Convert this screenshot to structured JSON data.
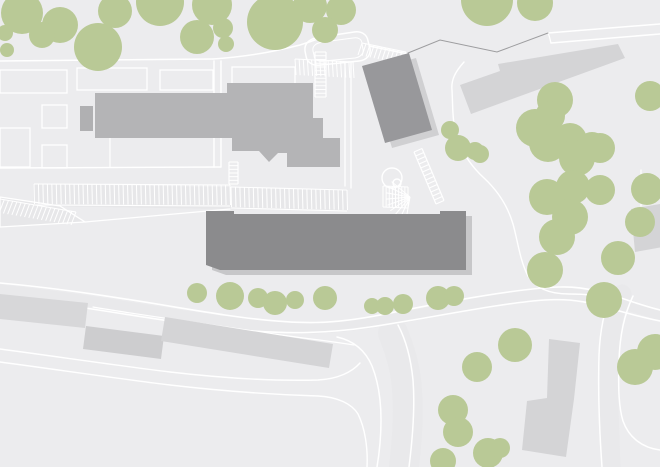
{
  "canvas": {
    "width": 660,
    "height": 467
  },
  "palette": {
    "background": "#ececee",
    "roadSurface": "#e9e9eb",
    "parkingSurface": "#e7e7e9",
    "line": "#ffffff",
    "boundary": "#9d9d9f",
    "tree": "#b9c996",
    "buildingMain": "#b4b4b6",
    "buildingAnnex": "#b0b0b2",
    "buildingDark": "#98989b",
    "buildingLong": "#8b8b8d",
    "shadowLong": "#c7c7c9",
    "shadowDark": "#d0d0d2",
    "buildingLightA": "#d7d7d9",
    "buildingLightB": "#cdcdcf",
    "buildingLightC": "#d4d4d6"
  },
  "map": {
    "layers": [
      {
        "name": "background-layer",
        "type": "fills",
        "color": "background",
        "items": [
          {
            "d": "M0,0 L660,0 L660,467 L0,467 Z",
            "name": "ground"
          }
        ]
      },
      {
        "name": "road-surface-layer",
        "type": "paths",
        "color": "roadSurface",
        "items": [
          {
            "d": "M0,290 C90,299 170,315 228,322 C300,332 335,329 395,319 C455,308 520,293 555,293 C585,293 620,302 660,315",
            "w": 11,
            "name": "main-road-surface"
          },
          {
            "d": "M393,333 C400,350 406,370 407,390 C409,415 407,440 404,467",
            "w": 30,
            "name": "south-branch-surface"
          },
          {
            "d": "M622,294 C613,312 609,335 609,365 C608,400 610,430 611,467",
            "w": 19,
            "name": "east-road-surface"
          }
        ]
      },
      {
        "name": "parking-surface-layer",
        "type": "fills",
        "color": "parkingSurface",
        "items": [
          {
            "d": "M33,184 L347,189 L347,211 L33,206 Z",
            "name": "parking-lot-surface"
          },
          {
            "d": "M0,197 L60,206 L85,222 L0,227 Z",
            "name": "parking-wedge-surface"
          }
        ]
      },
      {
        "name": "road-line-layer",
        "type": "paths",
        "color": "line",
        "items": [
          {
            "d": "M0,61 L213,59",
            "w": 1.5,
            "name": "north-street"
          },
          {
            "d": "M213,59 C255,56 280,50 300,45 C310,42 315,40 320,38",
            "w": 1.5,
            "name": "north-street-curve"
          },
          {
            "d": "M321,37 C310,38 304,43 305,51 L306,56 C307,63 313,66 321,65 L359,61 C367,60 371,55 370,48 L368,41 C367,34 361,31 354,32 Z",
            "w": 1.5,
            "name": "turnaround-loop-outer"
          },
          {
            "d": "M323,42 C316,43 312,46 313,51 L314,55 C314,60 318,62 324,61 L355,58 C361,57 364,53 363,49 L362,44 C362,39 358,37 353,38 Z",
            "w": 1,
            "name": "turnaround-loop-inner"
          },
          {
            "d": "M369,46 L408,54",
            "w": 1.5,
            "name": "loop-spur"
          },
          {
            "d": "M214,61 L214,167",
            "w": 1.4,
            "name": "access-lane-west-edge"
          },
          {
            "d": "M221,61 L221,167",
            "w": 1.4,
            "name": "access-lane-east-edge"
          },
          {
            "d": "M0,168 L221,167",
            "w": 1.4,
            "name": "parking-approach"
          },
          {
            "d": "M110,94 L110,167",
            "w": 1.2,
            "name": "plot-divider"
          },
          {
            "d": "M345,63 L345,186",
            "w": 1.3,
            "name": "service-lane-west"
          },
          {
            "d": "M351,63 L351,188",
            "w": 1.3,
            "name": "service-lane-east"
          },
          {
            "d": "M548,33 L660,24",
            "w": 1.5,
            "name": "northeast-road-upper"
          },
          {
            "d": "M551,43 L660,34",
            "w": 1.5,
            "name": "northeast-road-lower"
          },
          {
            "d": "M548,33 C550,37 550,40 551,43",
            "w": 1.3,
            "name": "northeast-road-cap"
          },
          {
            "d": "M464,62 C455,72 451,80 452,90 C453,108 452,124 458,140 C464,156 473,168 484,178 C498,191 508,207 513,224 C518,242 520,261 528,276 C536,289 551,294 569,294 C584,294 599,295 609,299",
            "w": 1.4,
            "name": "grove-footpath"
          },
          {
            "d": "M641,170 L641,206",
            "w": 1.2,
            "name": "east-building-path"
          },
          {
            "d": "M0,283 C90,291 170,307 225,315 C300,326 335,325 395,312 C450,301 520,288 560,287 C585,286 610,294 630,301 C645,306 652,308 660,310",
            "w": 1.6,
            "name": "main-road-north-edge"
          },
          {
            "d": "M0,296 C90,307 170,323 230,329 C290,335 330,333 370,327 C430,318 500,303 545,300 C575,298 595,304 612,309 C630,314 645,318 660,321",
            "w": 1.6,
            "name": "main-road-south-edge"
          },
          {
            "d": "M93,307 C140,315 200,323 260,332 C300,338 330,341 354,345",
            "w": 1.2,
            "name": "lower-terrace-line"
          },
          {
            "d": "M0,349 C60,357 120,366 170,372 C230,379 280,381 318,380 C338,379 352,372 360,363",
            "w": 1.4,
            "name": "sidewalk-upper"
          },
          {
            "d": "M0,362 C60,370 120,379 170,385 C230,392 285,395 318,396 C338,397 352,404 358,414 C365,428 368,448 367,467",
            "w": 1.4,
            "name": "sidewalk-lower"
          },
          {
            "d": "M337,337 C355,341 366,352 372,366 C378,381 381,400 381,420 C381,440 379,455 377,467",
            "w": 1.5,
            "name": "south-branch-west-edge"
          },
          {
            "d": "M398,325 C406,340 411,360 413,380 C415,405 413,435 409,467",
            "w": 1.5,
            "name": "south-branch-east-edge"
          },
          {
            "d": "M612,292 C604,310 600,330 599,355 C598,390 599,425 602,467",
            "w": 1.5,
            "name": "east-road-west-edge"
          },
          {
            "d": "M633,296 C624,315 620,335 619,360 C618,390 619,408 623,421 C629,438 643,448 660,450",
            "w": 1.5,
            "name": "east-road-east-edge"
          }
        ]
      },
      {
        "name": "plot-outline-layer",
        "type": "rects",
        "color": "line",
        "items": [
          [
            0,
            70,
            67,
            23
          ],
          [
            77,
            68,
            70,
            22
          ],
          [
            160,
            70,
            53,
            20
          ],
          [
            232,
            67,
            63,
            21
          ],
          [
            0,
            128,
            30,
            39
          ],
          [
            42,
            105,
            25,
            23
          ],
          [
            42,
            145,
            25,
            23
          ]
        ]
      },
      {
        "name": "parking-outline-layer",
        "type": "paths",
        "color": "line",
        "items": [
          {
            "d": "M0,197 L60,206 L85,222 L0,227 Z",
            "w": 1.3,
            "name": "parking-wedge-outline"
          },
          {
            "d": "M85,222 L230,209",
            "w": 1.3,
            "name": "parking-wedge-connector"
          }
        ]
      },
      {
        "name": "parking-stall-layer",
        "type": "ticks",
        "color": "line",
        "items": [
          {
            "b": [
              34,
              184,
              230,
              185
            ],
            "t": [
              0.5,
              20
            ],
            "n": 44,
            "bot": [
              34,
              205,
              230,
              206
            ],
            "name": "stall-row-west"
          },
          {
            "b": [
              231,
              187,
              347,
              190
            ],
            "t": [
              0.5,
              20
            ],
            "n": 26,
            "bot": [
              231,
              208,
              347,
              211
            ],
            "name": "stall-row-east"
          },
          {
            "b": [
              383,
              186,
              408,
              187
            ],
            "t": [
              0,
              21
            ],
            "n": 8,
            "bot": [
              383,
              207,
              408,
              208
            ],
            "name": "stall-row-detail"
          },
          {
            "b": [
              295,
              59,
              353,
              62
            ],
            "t": [
              1,
              16
            ],
            "n": 14,
            "name": "stall-row-loop-south"
          },
          {
            "b": [
              362,
              43,
              406,
              52
            ],
            "t": [
              -4,
              12
            ],
            "n": 11,
            "name": "stall-row-loop-east"
          },
          {
            "b": [
              0,
              199,
              76,
              212
            ],
            "t": [
              -5,
              13
            ],
            "n": 18,
            "name": "wedge-hatch"
          }
        ]
      },
      {
        "name": "stairs-layer",
        "type": "ladders",
        "color": "line",
        "items": [
          {
            "a": [
              315,
              52,
              315,
              97
            ],
            "o": [
              11,
              0
            ],
            "n": 12,
            "name": "stairs-north"
          },
          {
            "a": [
              414,
              152,
              436,
              204
            ],
            "o": [
              8,
              -3.5
            ],
            "n": 13,
            "name": "stairs-east-ramp"
          },
          {
            "a": [
              229,
              162,
              229,
              184
            ],
            "o": [
              9,
              0
            ],
            "n": 6,
            "name": "stairs-parking"
          }
        ]
      },
      {
        "name": "courtyard-detail-layer",
        "type": "fan",
        "color": "line",
        "items": [
          {
            "c": [
              410,
              197
            ],
            "r": 24,
            "angles": [
              100,
              115,
              130,
              145,
              160,
              175,
              190,
              205,
              220
            ],
            "name": "bike-rack-fan"
          }
        ]
      },
      {
        "name": "courtyard-ring-layer",
        "type": "rings",
        "color": "line",
        "items": [
          [
            392,
            178,
            10
          ],
          [
            397,
            183,
            4
          ]
        ]
      },
      {
        "name": "boundary-layer",
        "type": "paths",
        "color": "boundary",
        "items": [
          {
            "d": "M408,53 L440,40 L497,52 L548,33",
            "w": 1,
            "name": "property-boundary"
          }
        ]
      },
      {
        "name": "shadow-layer",
        "type": "polys",
        "items": [
          {
            "d": "M206,211 L234,211 L234,214 L440,214 L440,211 L466,211 L466,270 L220,270 L206,265 Z",
            "fill": "shadowLong",
            "t": "translate(6,5)",
            "name": "long-building-shadow"
          },
          {
            "d": "M362,66 L409,53 L432,130 L385,143 Z",
            "fill": "shadowDark",
            "t": "translate(7,5)",
            "name": "hall-shadow"
          }
        ]
      },
      {
        "name": "building-layer",
        "type": "polys",
        "items": [
          {
            "d": "M80,106 L93,106 L93,131 L80,131 Z",
            "fill": "buildingAnnex",
            "name": "building-annex"
          },
          {
            "d": "M95,93 L227,93 L227,83 L313,83 L313,118 L323,118 L323,138 L340,138 L340,167 L287,167 L287,153 L278,153 L269,162 L259,151 L232,151 L232,138 L95,138 Z",
            "fill": "buildingMain",
            "name": "building-main-complex"
          },
          {
            "d": "M362,66 L409,53 L432,130 L385,143 Z",
            "fill": "buildingDark",
            "name": "building-hall"
          },
          {
            "d": "M206,211 L234,211 L234,214 L440,214 L440,211 L466,211 L466,270 L220,270 L206,265 Z",
            "fill": "buildingLong",
            "name": "building-long-block"
          },
          {
            "d": "M0,294 L88,303 L85,328 L0,319 Z",
            "fill": "buildingLightA",
            "name": "building-row-west"
          },
          {
            "d": "M86,326 L164,336 L161,359 L83,349 Z",
            "fill": "buildingLightB",
            "name": "building-row-middle"
          },
          {
            "d": "M165,317 L333,344 L329,368 L161,341 Z",
            "fill": "buildingLightC",
            "name": "building-row-east"
          },
          {
            "d": "M549,339 L580,343 L574,399 L566,457 L522,450 L527,401 L547,398 Z",
            "fill": "buildingLightC",
            "name": "building-south-tower"
          },
          {
            "d": "M631,209 L660,204 L663,247 L635,252 Z",
            "fill": "buildingLightC",
            "name": "building-east-small"
          },
          {
            "d": "M460,85 L500,71 L498,64 L618,44 L625,58 L471,114 Z",
            "fill": "buildingLightC",
            "name": "building-northeast-slab"
          }
        ]
      },
      {
        "name": "tree-layer",
        "type": "circles",
        "color": "tree",
        "items": [
          [
            22,
            13,
            21
          ],
          [
            5,
            33,
            8
          ],
          [
            7,
            50,
            7
          ],
          [
            60,
            25,
            18
          ],
          [
            42,
            35,
            13
          ],
          [
            98,
            47,
            24
          ],
          [
            115,
            11,
            17
          ],
          [
            160,
            2,
            24
          ],
          [
            197,
            37,
            17
          ],
          [
            212,
            5,
            20
          ],
          [
            223,
            28,
            10
          ],
          [
            226,
            44,
            8
          ],
          [
            275,
            22,
            28
          ],
          [
            310,
            6,
            17
          ],
          [
            341,
            10,
            15
          ],
          [
            325,
            30,
            13
          ],
          [
            487,
            0,
            26
          ],
          [
            535,
            3,
            18
          ],
          [
            450,
            130,
            9
          ],
          [
            456,
            147,
            10
          ],
          [
            475,
            151,
            9
          ],
          [
            458,
            148,
            13
          ],
          [
            480,
            154,
            9
          ],
          [
            555,
            100,
            18
          ],
          [
            550,
            116,
            15
          ],
          [
            535,
            128,
            19
          ],
          [
            570,
            140,
            17
          ],
          [
            592,
            147,
            15
          ],
          [
            650,
            96,
            15
          ],
          [
            548,
            143,
            19
          ],
          [
            577,
            158,
            18
          ],
          [
            600,
            148,
            15
          ],
          [
            573,
            187,
            17
          ],
          [
            600,
            190,
            15
          ],
          [
            547,
            197,
            18
          ],
          [
            647,
            189,
            16
          ],
          [
            570,
            217,
            18
          ],
          [
            640,
            222,
            15
          ],
          [
            557,
            237,
            18
          ],
          [
            618,
            258,
            17
          ],
          [
            545,
            270,
            18
          ],
          [
            604,
            300,
            18
          ],
          [
            655,
            352,
            18
          ],
          [
            197,
            293,
            10
          ],
          [
            230,
            296,
            14
          ],
          [
            258,
            298,
            10
          ],
          [
            275,
            303,
            12
          ],
          [
            295,
            300,
            9
          ],
          [
            325,
            298,
            12
          ],
          [
            372,
            306,
            8
          ],
          [
            385,
            306,
            9
          ],
          [
            403,
            304,
            10
          ],
          [
            438,
            298,
            12
          ],
          [
            454,
            296,
            10
          ],
          [
            515,
            345,
            17
          ],
          [
            477,
            367,
            15
          ],
          [
            453,
            410,
            15
          ],
          [
            458,
            432,
            15
          ],
          [
            488,
            453,
            15
          ],
          [
            443,
            461,
            13
          ],
          [
            500,
            448,
            10
          ],
          [
            635,
            367,
            18
          ]
        ]
      }
    ]
  }
}
